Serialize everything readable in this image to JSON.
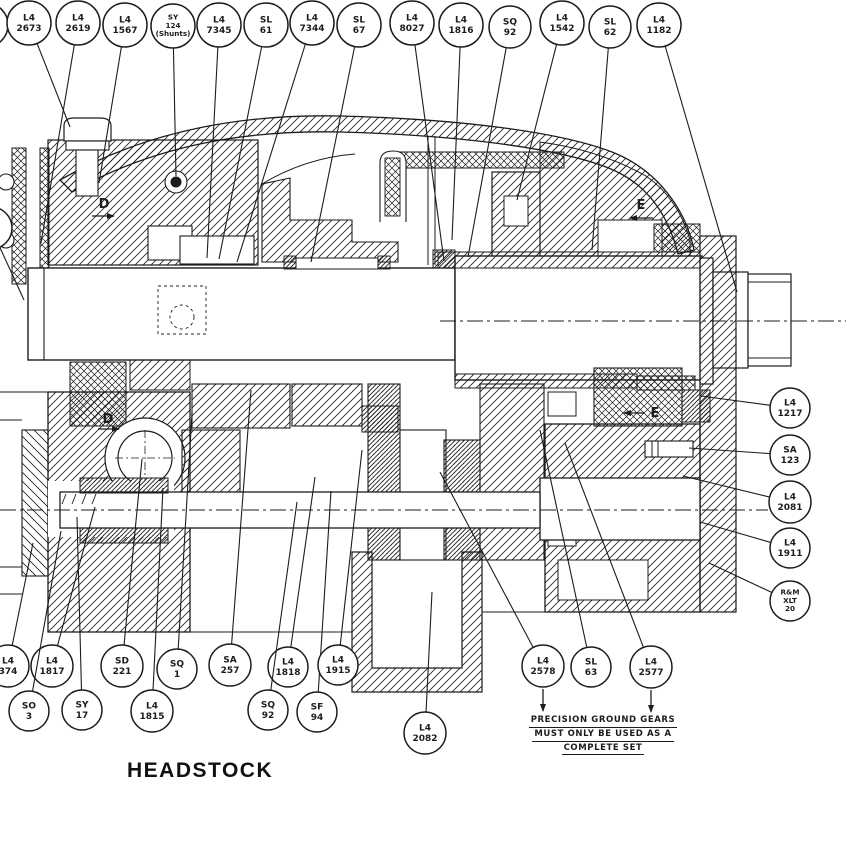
{
  "title": "HEADSTOCK",
  "note": {
    "line1": "PRECISION GROUND GEARS",
    "line2": "MUST ONLY BE USED AS A",
    "line3": "COMPLETE SET"
  },
  "colors": {
    "ink": "#1c1c1c",
    "paper": "#ffffff"
  },
  "view_markers": [
    {
      "label": "D",
      "x": 104,
      "y": 208,
      "ax1": 92,
      "ay1": 216,
      "ax2": 114,
      "ay2": 216
    },
    {
      "label": "E",
      "x": 641,
      "y": 209,
      "ax1": 653,
      "ay1": 218,
      "ax2": 630,
      "ay2": 218
    },
    {
      "label": "D",
      "x": 108,
      "y": 423,
      "ax1": 98,
      "ay1": 429,
      "ax2": 119,
      "ay2": 429
    },
    {
      "label": "E",
      "x": 655,
      "y": 417,
      "ax1": 645,
      "ay1": 413,
      "ax2": 624,
      "ay2": 413
    }
  ],
  "balloons": [
    {
      "lines": [],
      "cx": -14,
      "cy": 25,
      "r": 22
    },
    {
      "lines": [
        "L4",
        "2673"
      ],
      "cx": 29,
      "cy": 23,
      "r": 22,
      "tx": 70,
      "ty": 127
    },
    {
      "lines": [
        "L4",
        "2619"
      ],
      "cx": 78,
      "cy": 23,
      "r": 22,
      "tx": 41,
      "ty": 243
    },
    {
      "lines": [
        "L4",
        "1567"
      ],
      "cx": 125,
      "cy": 25,
      "r": 22,
      "tx": 99,
      "ty": 183
    },
    {
      "lines": [
        "SY",
        "124",
        "(Shunts)"
      ],
      "cx": 173,
      "cy": 26,
      "r": 22,
      "tx": 176,
      "ty": 176
    },
    {
      "lines": [
        "L4",
        "7345"
      ],
      "cx": 219,
      "cy": 25,
      "r": 22,
      "tx": 207,
      "ty": 258
    },
    {
      "lines": [
        "SL",
        "61"
      ],
      "cx": 266,
      "cy": 25,
      "r": 22,
      "tx": 219,
      "ty": 259
    },
    {
      "lines": [
        "L4",
        "7344"
      ],
      "cx": 312,
      "cy": 23,
      "r": 22,
      "tx": 237,
      "ty": 262
    },
    {
      "lines": [
        "SL",
        "67"
      ],
      "cx": 359,
      "cy": 25,
      "r": 22,
      "tx": 311,
      "ty": 262
    },
    {
      "lines": [
        "L4",
        "8027"
      ],
      "cx": 412,
      "cy": 23,
      "r": 22,
      "tx": 444,
      "ty": 261
    },
    {
      "lines": [
        "L4",
        "1816"
      ],
      "cx": 461,
      "cy": 25,
      "r": 22,
      "tx": 452,
      "ty": 240
    },
    {
      "lines": [
        "SQ",
        "92"
      ],
      "cx": 510,
      "cy": 27,
      "r": 21,
      "tx": 468,
      "ty": 257
    },
    {
      "lines": [
        "L4",
        "1542"
      ],
      "cx": 562,
      "cy": 23,
      "r": 22,
      "tx": 517,
      "ty": 200
    },
    {
      "lines": [
        "SL",
        "62"
      ],
      "cx": 610,
      "cy": 27,
      "r": 21,
      "tx": 592,
      "ty": 250
    },
    {
      "lines": [
        "L4",
        "1182"
      ],
      "cx": 659,
      "cy": 25,
      "r": 22,
      "tx": 737,
      "ty": 292
    },
    {
      "lines": [
        "L4",
        "9"
      ],
      "cx": -9,
      "cy": 228,
      "r": 21,
      "tx": 24,
      "ty": 300
    },
    {
      "lines": [
        "L4",
        "1217"
      ],
      "cx": 790,
      "cy": 408,
      "r": 20,
      "tx": 701,
      "ty": 396
    },
    {
      "lines": [
        "SA",
        "123"
      ],
      "cx": 790,
      "cy": 455,
      "r": 20,
      "tx": 689,
      "ty": 448
    },
    {
      "lines": [
        "L4",
        "2081"
      ],
      "cx": 790,
      "cy": 502,
      "r": 21,
      "tx": 683,
      "ty": 476
    },
    {
      "lines": [
        "L4",
        "1911"
      ],
      "cx": 790,
      "cy": 548,
      "r": 20,
      "tx": 700,
      "ty": 522
    },
    {
      "lines": [
        "R&M",
        "XLT",
        "20"
      ],
      "cx": 790,
      "cy": 601,
      "r": 20,
      "tx": 709,
      "ty": 563
    },
    {
      "lines": [
        "L4",
        "374"
      ],
      "cx": 8,
      "cy": 666,
      "r": 21,
      "tx": 33,
      "ty": 543
    },
    {
      "lines": [
        "L4",
        "1817"
      ],
      "cx": 52,
      "cy": 666,
      "r": 21,
      "tx": 95,
      "ty": 507
    },
    {
      "lines": [
        "SD",
        "221"
      ],
      "cx": 122,
      "cy": 666,
      "r": 21,
      "tx": 142,
      "ty": 459
    },
    {
      "lines": [
        "SQ",
        "1"
      ],
      "cx": 177,
      "cy": 669,
      "r": 20,
      "tx": 192,
      "ty": 413
    },
    {
      "lines": [
        "SA",
        "257"
      ],
      "cx": 230,
      "cy": 665,
      "r": 21,
      "tx": 251,
      "ty": 390
    },
    {
      "lines": [
        "SO",
        "3"
      ],
      "cx": 29,
      "cy": 711,
      "r": 20,
      "tx": 61,
      "ty": 531
    },
    {
      "lines": [
        "SY",
        "17"
      ],
      "cx": 82,
      "cy": 710,
      "r": 20,
      "tx": 77,
      "ty": 517
    },
    {
      "lines": [
        "L4",
        "1815"
      ],
      "cx": 152,
      "cy": 711,
      "r": 21,
      "tx": 163,
      "ty": 488
    },
    {
      "lines": [
        "L4",
        "1818"
      ],
      "cx": 288,
      "cy": 667,
      "r": 20,
      "tx": 315,
      "ty": 477
    },
    {
      "lines": [
        "SQ",
        "92"
      ],
      "cx": 268,
      "cy": 710,
      "r": 20,
      "tx": 297,
      "ty": 502
    },
    {
      "lines": [
        "SF",
        "94"
      ],
      "cx": 317,
      "cy": 712,
      "r": 20,
      "tx": 331,
      "ty": 491
    },
    {
      "lines": [
        "L4",
        "1915"
      ],
      "cx": 338,
      "cy": 665,
      "r": 20,
      "tx": 362,
      "ty": 450
    },
    {
      "lines": [
        "L4",
        "2082"
      ],
      "cx": 425,
      "cy": 733,
      "r": 21,
      "tx": 432,
      "ty": 592
    },
    {
      "lines": [
        "L4",
        "2578"
      ],
      "cx": 543,
      "cy": 666,
      "r": 21,
      "tx": 440,
      "ty": 472,
      "down_arrow": true
    },
    {
      "lines": [
        "SL",
        "63"
      ],
      "cx": 591,
      "cy": 667,
      "r": 20,
      "tx": 540,
      "ty": 430
    },
    {
      "lines": [
        "L4",
        "2577"
      ],
      "cx": 651,
      "cy": 667,
      "r": 21,
      "tx": 565,
      "ty": 443,
      "down_arrow": true
    }
  ]
}
